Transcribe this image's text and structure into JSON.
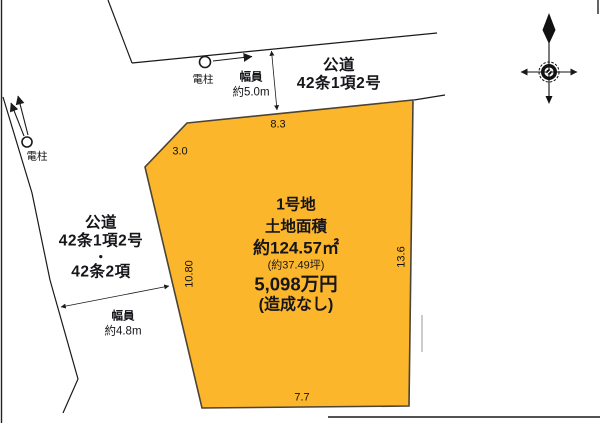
{
  "canvas": {
    "width": 600,
    "height": 423
  },
  "colors": {
    "parcel_fill": "#FBB62C",
    "parcel_stroke": "#4B4335",
    "line": "#1A1A1A",
    "text": "#15151A"
  },
  "top_road": {
    "name": "公道",
    "regulation": "42条1項2号"
  },
  "left_road": {
    "name": "公道",
    "regulation1": "42条1項2号",
    "separator": "・",
    "regulation2": "42条2項"
  },
  "top_width": {
    "label": "幅員",
    "value": "約5.0m"
  },
  "left_width": {
    "label": "幅員",
    "value": "約4.8m"
  },
  "top_pole": {
    "label": "電柱"
  },
  "left_pole": {
    "label": "電柱"
  },
  "parcel": {
    "title": "1号地",
    "area_label": "土地面積",
    "area_sqm": "約124.57㎡",
    "area_tsubo": "(約37.49坪)",
    "price": "5,098万円",
    "note": "(造成なし)"
  },
  "dimensions": {
    "top_edge": "8.3",
    "chamfer_edge": "3.0",
    "west_edge": "10.80",
    "east_edge": "13.6",
    "bottom_edge": "7.7"
  }
}
